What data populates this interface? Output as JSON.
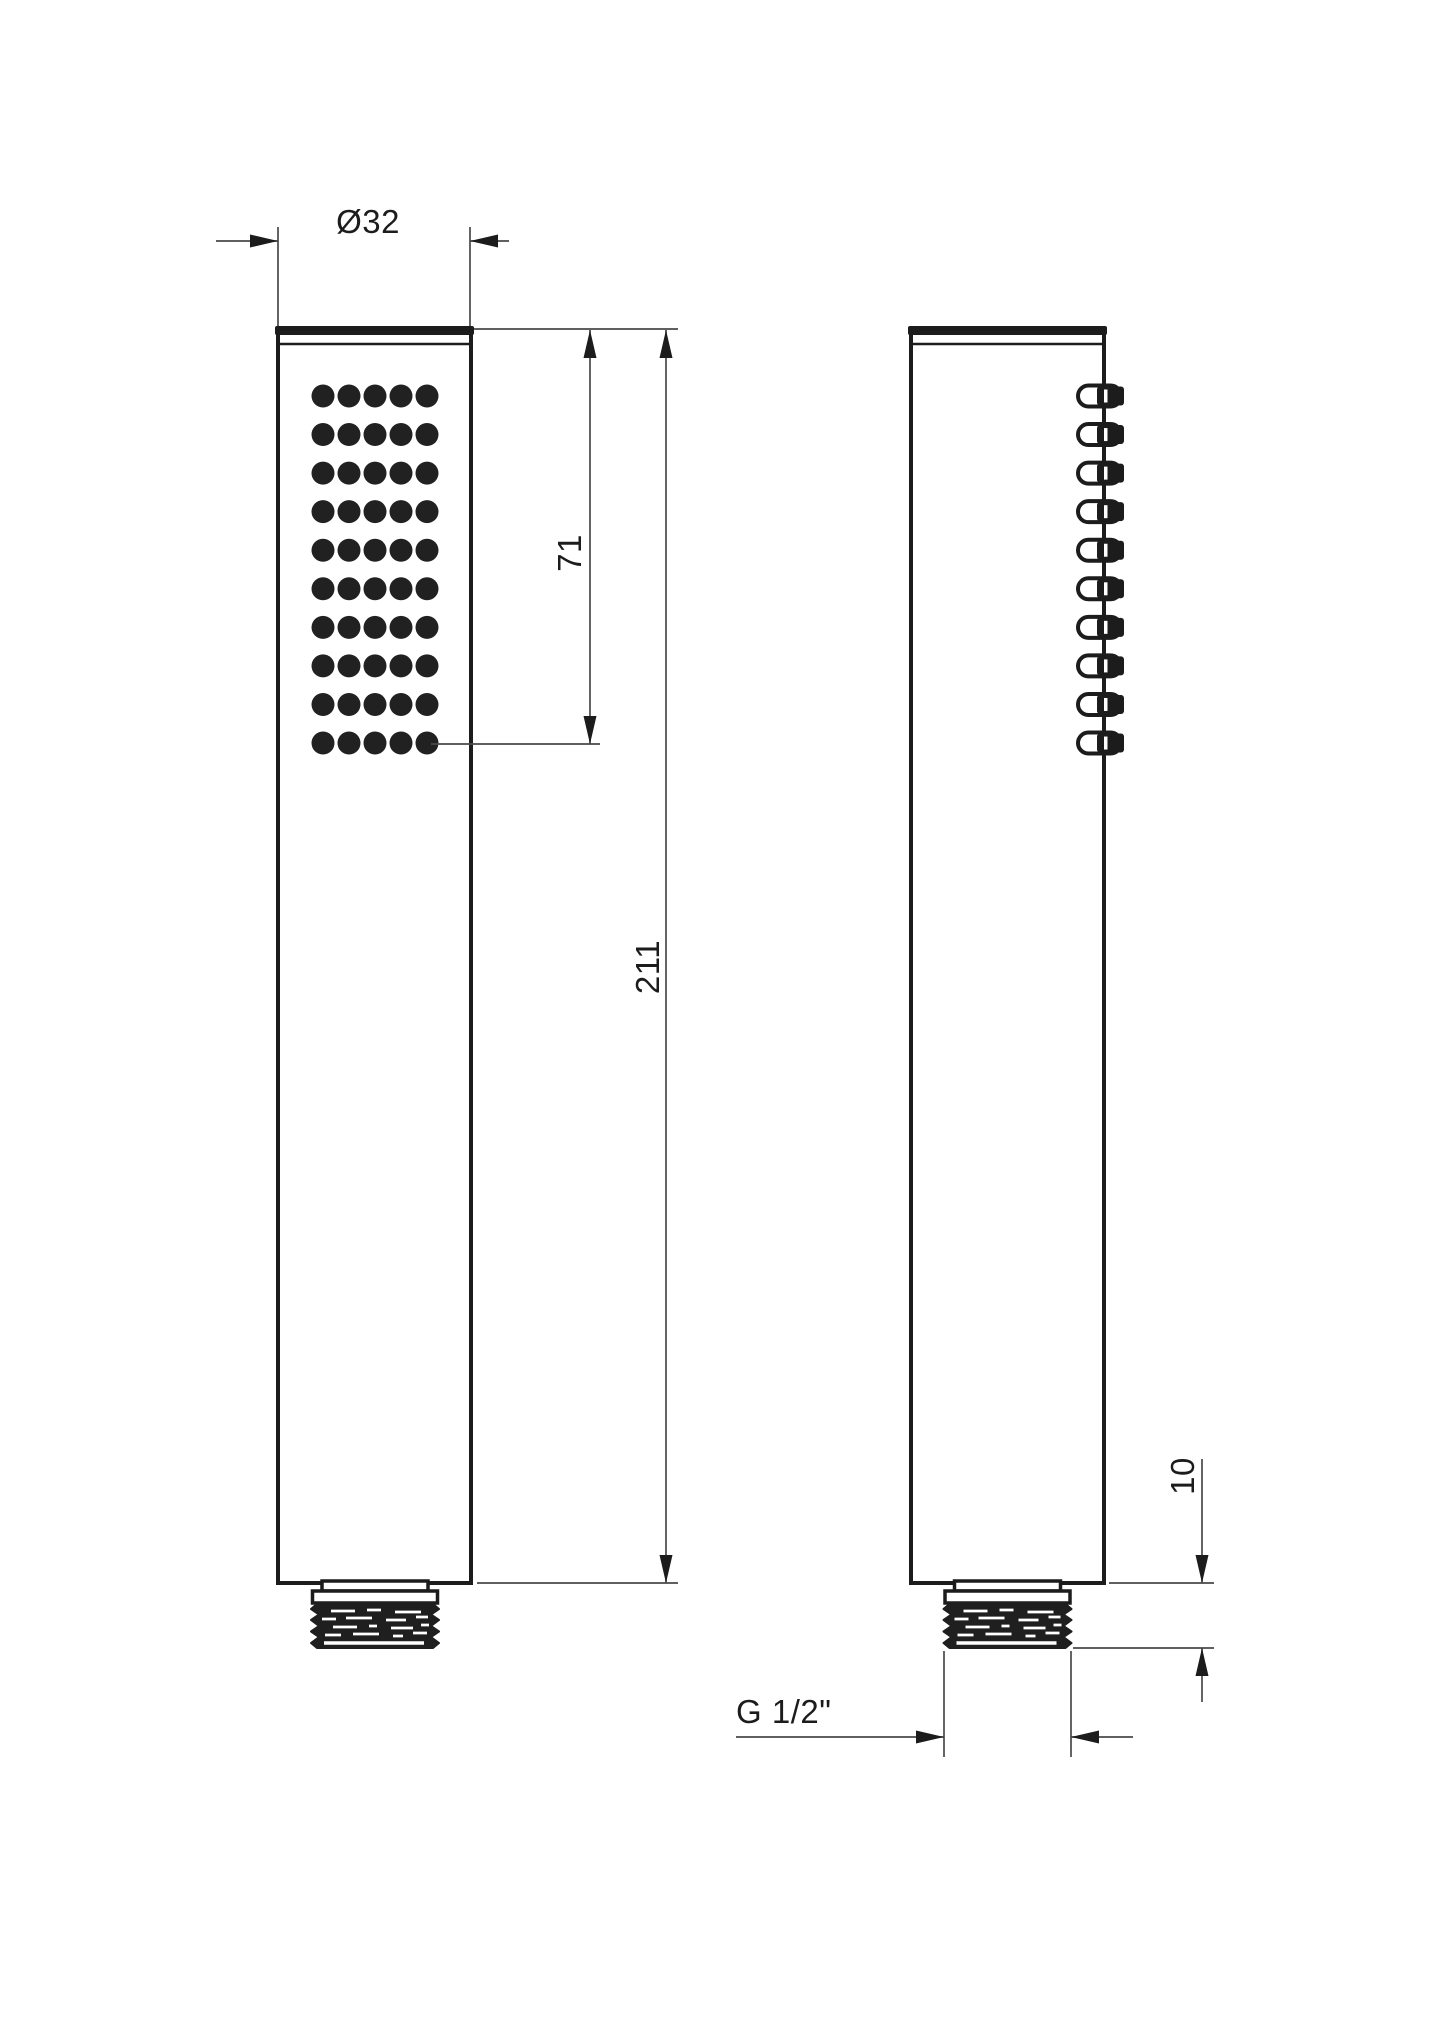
{
  "colors": {
    "background": "#ffffff",
    "outline": "#1c1c1c",
    "dimension_line": "#4a4a4a",
    "spray_dot": "#212121"
  },
  "dimensions": {
    "diameter": "Ø32",
    "spray_face_length": "71",
    "total_length": "211",
    "thread_length": "10",
    "thread_spec": "G 1/2\""
  },
  "front_view": {
    "spray_dot_rows": 10,
    "spray_dot_cols": 5
  },
  "side_view": {
    "nozzle_count": 10
  }
}
